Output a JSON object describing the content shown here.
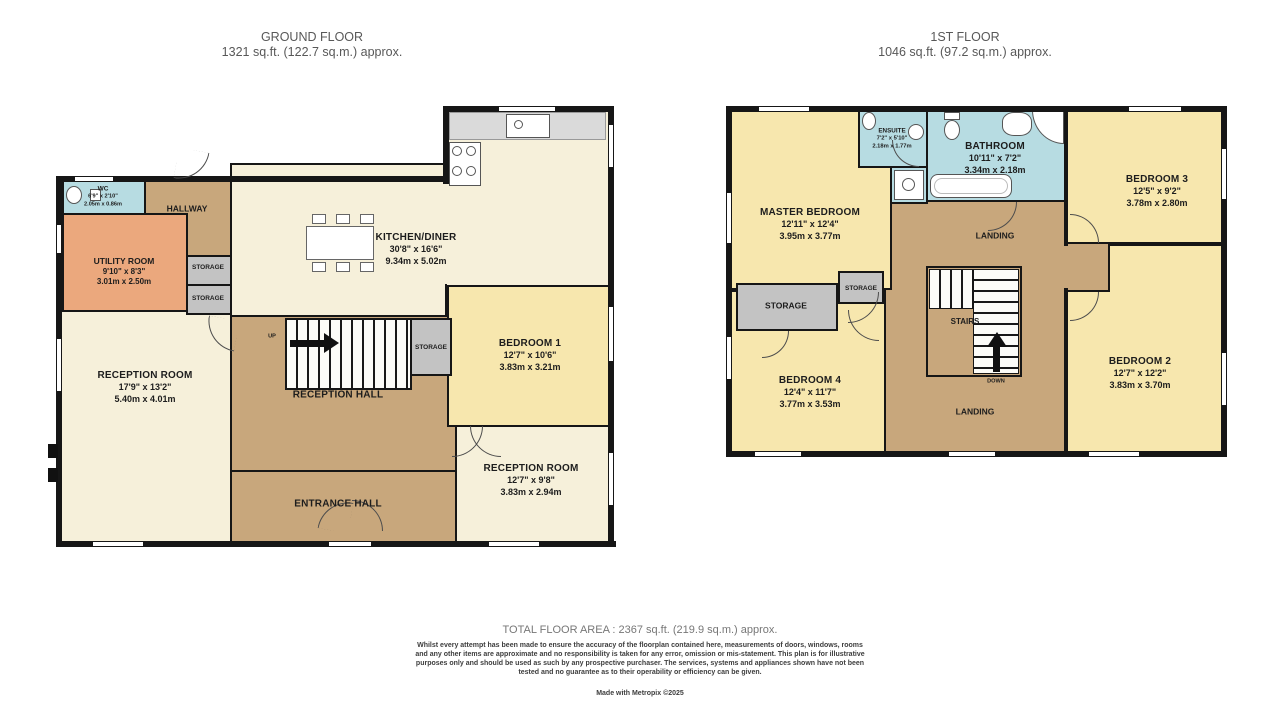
{
  "ground_floor": {
    "title": "GROUND FLOOR",
    "area_label": "1321 sq.ft. (122.7 sq.m.) approx.",
    "rooms": {
      "wc": {
        "name": "WC",
        "dims_ft": "6'9\" x 2'10\"",
        "dims_m": "2.05m x 0.86m"
      },
      "hallway": {
        "name": "HALLWAY"
      },
      "utility_room": {
        "name": "UTILITY ROOM",
        "dims_ft": "9'10\" x 8'3\"",
        "dims_m": "3.01m x 2.50m"
      },
      "kitchen_diner": {
        "name": "KITCHEN/DINER",
        "dims_ft": "30'8\" x 16'6\"",
        "dims_m": "9.34m x 5.02m"
      },
      "bedroom_1": {
        "name": "BEDROOM 1",
        "dims_ft": "12'7\" x 10'6\"",
        "dims_m": "3.83m x 3.21m"
      },
      "reception_room_1": {
        "name": "RECEPTION ROOM",
        "dims_ft": "17'9\" x 13'2\"",
        "dims_m": "5.40m x 4.01m"
      },
      "reception_room_2": {
        "name": "RECEPTION ROOM",
        "dims_ft": "12'7\" x 9'8\"",
        "dims_m": "3.83m x 2.94m"
      },
      "reception_hall": {
        "name": "RECEPTION HALL"
      },
      "entrance_hall": {
        "name": "ENTRANCE HALL"
      },
      "storage_1": {
        "name": "STORAGE"
      },
      "storage_2": {
        "name": "STORAGE"
      },
      "storage_3": {
        "name": "STORAGE"
      },
      "stairs_direction": "UP"
    }
  },
  "first_floor": {
    "title": "1ST FLOOR",
    "area_label": "1046 sq.ft. (97.2 sq.m.) approx.",
    "rooms": {
      "master_bedroom": {
        "name": "MASTER BEDROOM",
        "dims_ft": "12'11\" x 12'4\"",
        "dims_m": "3.95m x 3.77m"
      },
      "ensuite": {
        "name": "ENSUITE",
        "dims_ft": "7'2\" x 5'10\"",
        "dims_m": "2.18m x 1.77m"
      },
      "bathroom": {
        "name": "BATHROOM",
        "dims_ft": "10'11\" x 7'2\"",
        "dims_m": "3.34m x 2.18m"
      },
      "bedroom_3": {
        "name": "BEDROOM 3",
        "dims_ft": "12'5\" x 9'2\"",
        "dims_m": "3.78m x 2.80m"
      },
      "bedroom_2": {
        "name": "BEDROOM 2",
        "dims_ft": "12'7\" x 12'2\"",
        "dims_m": "3.83m x 3.70m"
      },
      "bedroom_4": {
        "name": "BEDROOM 4",
        "dims_ft": "12'4\" x 11'7\"",
        "dims_m": "3.77m x 3.53m"
      },
      "landing_top": {
        "name": "LANDING"
      },
      "landing_bottom": {
        "name": "LANDING"
      },
      "storage_a": {
        "name": "STORAGE"
      },
      "storage_b": {
        "name": "STORAGE"
      },
      "stairs": {
        "name": "STAIRS"
      },
      "stairs_direction": "DOWN"
    }
  },
  "footer": {
    "total_area": "TOTAL FLOOR AREA : 2367 sq.ft. (219.9 sq.m.) approx.",
    "disclaimer": "Whilst every attempt has been made to ensure the accuracy of the floorplan contained here, measurements of doors, windows, rooms and any other items are approximate and no responsibility is taken for any error, omission or mis-statement. This plan is for illustrative purposes only and should be used as such by any prospective purchaser. The services, systems and appliances shown have not been tested and no guarantee as to their operability or efficiency can be given.",
    "credit": "Made with Metropix ©2025"
  },
  "colors": {
    "wall": "#161616",
    "room_cream": "#f6f0da",
    "room_yellow": "#f7e7ae",
    "hall_tan": "#c8a77c",
    "utility_orange": "#eba87d",
    "wet_blue": "#b7dce2",
    "storage_gray": "#c3c3c3"
  }
}
